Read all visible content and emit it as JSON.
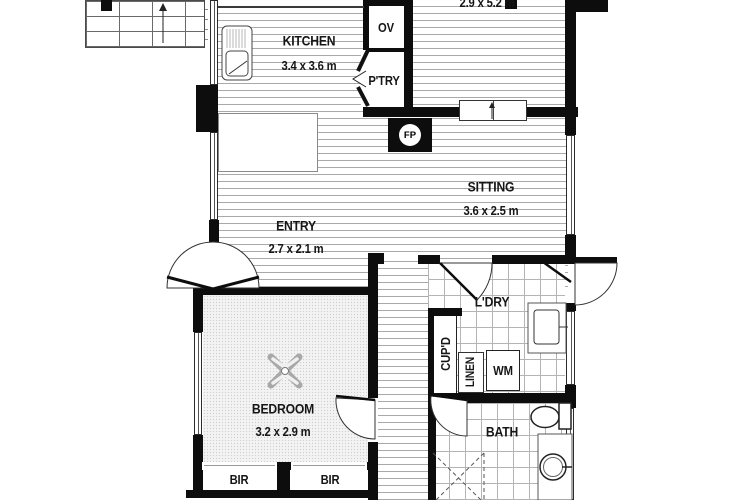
{
  "rooms": {
    "kitchen": {
      "name": "KITCHEN",
      "dims": "3.4 x 3.6 m"
    },
    "upper_room": {
      "dims": "2.9 x 5.2 m"
    },
    "sitting": {
      "name": "SITTING",
      "dims": "3.6 x 2.5 m"
    },
    "entry": {
      "name": "ENTRY",
      "dims": "2.7 x 2.1 m"
    },
    "bedroom": {
      "name": "BEDROOM",
      "dims": "3.2 x 2.9 m"
    },
    "laundry": {
      "name": "L'DRY"
    },
    "bath": {
      "name": "BATH"
    }
  },
  "fixtures": {
    "oven": "OV",
    "pantry": "P'TRY",
    "fireplace": "FP",
    "washing_machine": "WM",
    "cupboard": "CUP'D",
    "linen": "LINEN",
    "robe_left": "BIR",
    "robe_right": "BIR"
  },
  "colors": {
    "wall": "#0d0d0d",
    "floorboard_line": "#a9a9a9",
    "tile_line": "#b4b4b4",
    "carpet_base": "#f3f3f3"
  }
}
